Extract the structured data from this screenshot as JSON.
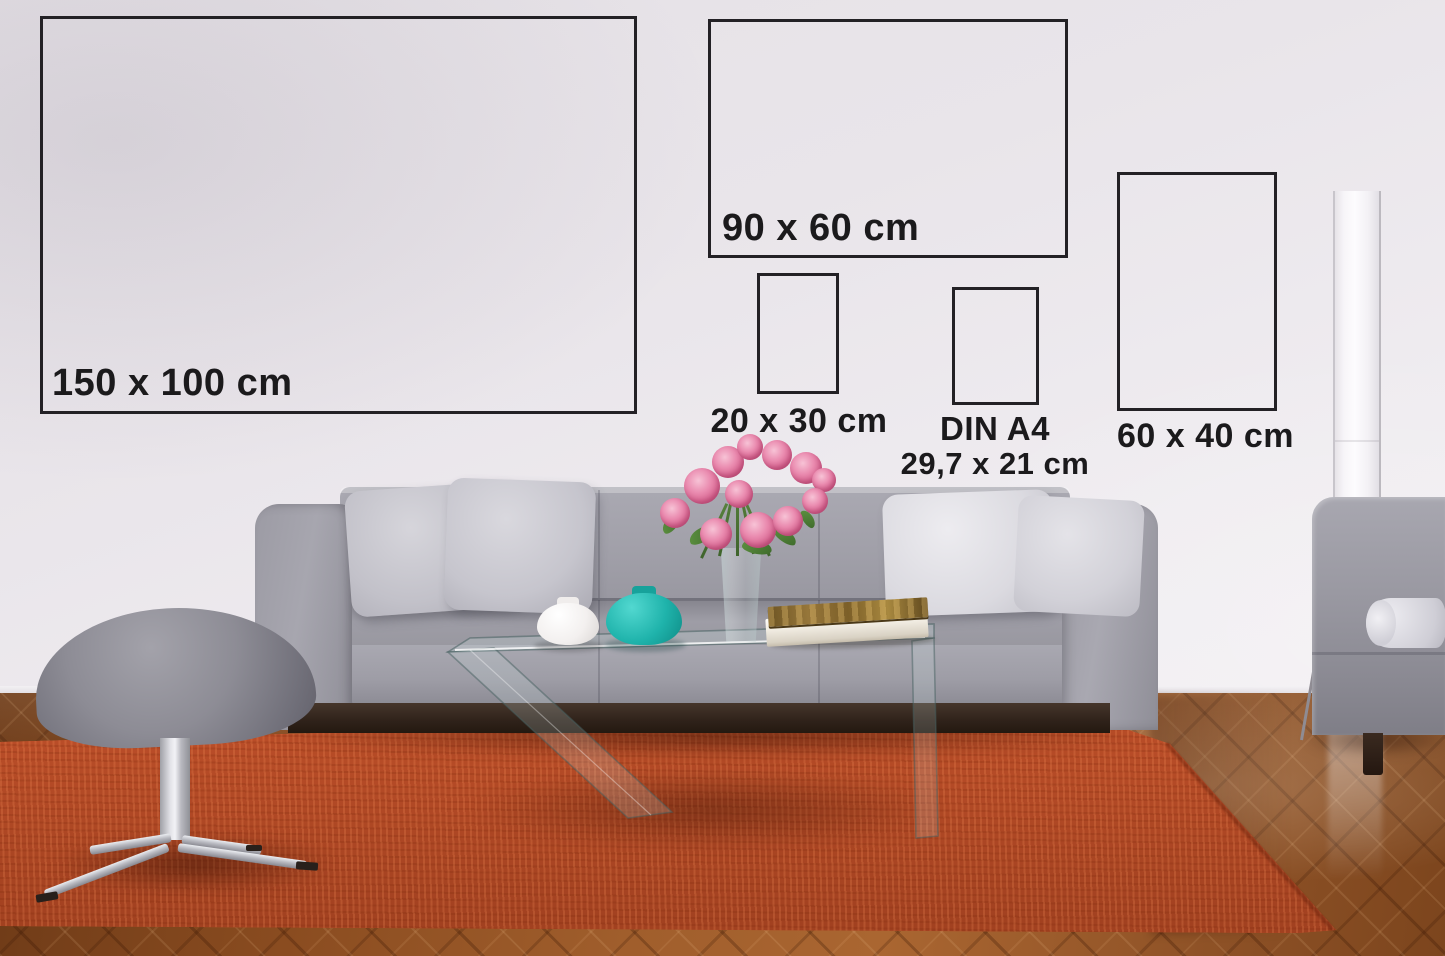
{
  "size_guide": {
    "frames": [
      {
        "id": "150x100",
        "label": "150 x 100 cm"
      },
      {
        "id": "90x60",
        "label": "90 x 60 cm"
      },
      {
        "id": "20x30",
        "label": "20 x 30 cm"
      },
      {
        "id": "din_a4",
        "label": "DIN A4",
        "sublabel": "29,7 x 21 cm"
      },
      {
        "id": "60x40",
        "label": "60 x 40 cm"
      }
    ],
    "frame_border_color": "#232125",
    "label_color": "#1b1a1c"
  },
  "scene": {
    "objects": [
      "wall",
      "wood-floor",
      "orange-rug",
      "gray-sofa",
      "sofa-pillows",
      "gray-ottoman",
      "glass-coffee-table",
      "white-vase",
      "teal-vase",
      "glass-flower-vase",
      "pink-flowers",
      "book",
      "floor-lamp",
      "side-sofa-with-bolster"
    ],
    "accent_colors": {
      "wall": "#eae6eb",
      "rug": "#c14f28",
      "sofa": "#9b9aa3",
      "teal_vase": "#1db3ac",
      "flowers": "#e27ba1",
      "wood_floor": "#98582a"
    }
  }
}
